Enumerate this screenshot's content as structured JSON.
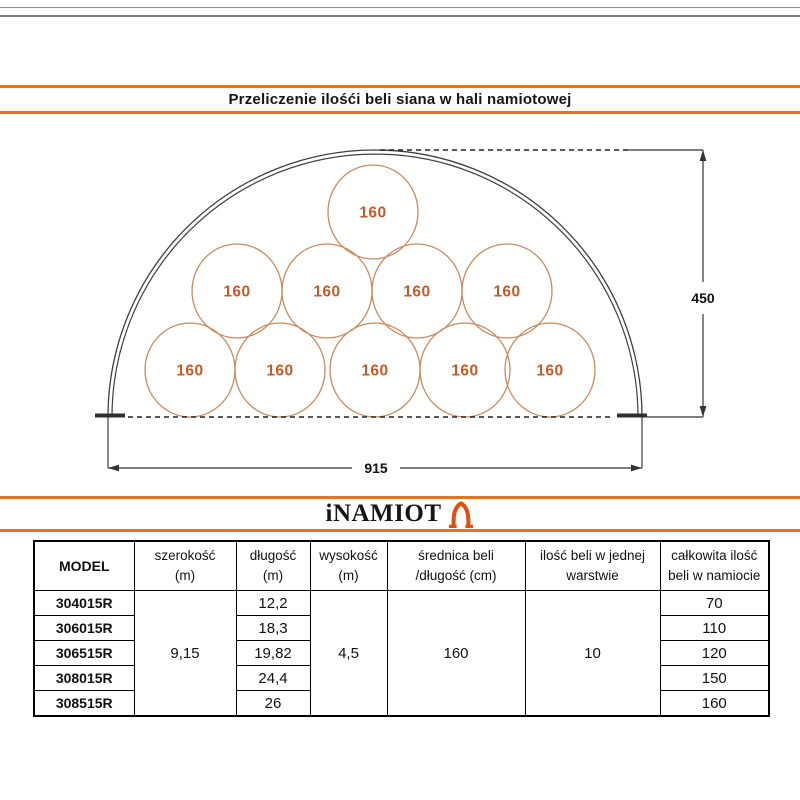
{
  "title_bar": {
    "title": "Przeliczenie ilośći beli siana w hali namiotowej"
  },
  "diagram": {
    "bale_label": "160",
    "bale_count_per_row": [
      5,
      4,
      1
    ],
    "total_bales_shown": 10,
    "height_dim_label": "450",
    "width_dim_label": "915",
    "colors": {
      "bale_stroke": "#c98a5e",
      "bale_text": "#c25b28",
      "frame_line": "#3f3f3f"
    }
  },
  "logo_bar": {
    "brand": "iNAMIOT",
    "icon": "tent-arch-icon",
    "accent": "#e8731a",
    "icon_color": "#e05010"
  },
  "table": {
    "headers": [
      {
        "line1": "MODEL",
        "line2": ""
      },
      {
        "line1": "szerokość",
        "line2": "(m)"
      },
      {
        "line1": "długość",
        "line2": "(m)"
      },
      {
        "line1": "wysokość",
        "line2": "(m)"
      },
      {
        "line1": "średnica beli",
        "line2": "/długość (cm)"
      },
      {
        "line1": "ilość beli w jednej",
        "line2": "warstwie"
      },
      {
        "line1": "całkowita ilość",
        "line2": "beli w namiocie"
      }
    ],
    "models": [
      "304015R",
      "306015R",
      "306515R",
      "308015R",
      "308515R"
    ],
    "szerokosc": "9,15",
    "dlugosc": [
      "12,2",
      "18,3",
      "19,82",
      "24,4",
      "26"
    ],
    "wysokosc": "4,5",
    "srednica_beli": "160",
    "ilosc_beli_w_warstwie": "10",
    "calkowita_ilosc": [
      "70",
      "110",
      "120",
      "150",
      "160"
    ]
  }
}
